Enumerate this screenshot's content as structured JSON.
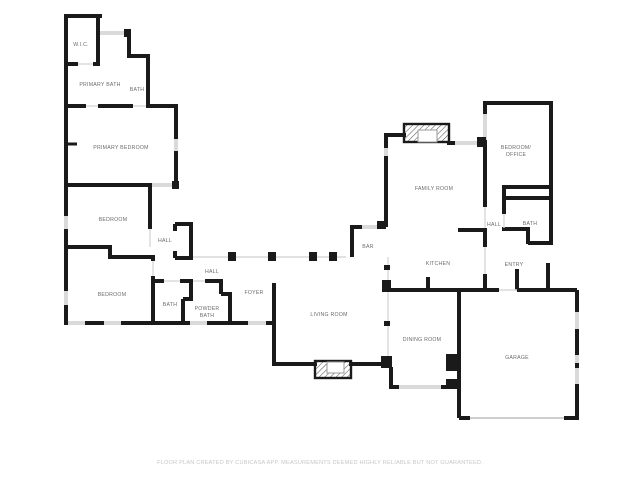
{
  "floor_plan": {
    "colors": {
      "wall": "#1a1a1a",
      "window": "#dadada",
      "opening": "#d9d9d9",
      "label": "#6b6b6b",
      "footer": "#c7c7c7"
    },
    "rooms": [
      {
        "label": "W.I.C."
      },
      {
        "label": "PRIMARY BATH"
      },
      {
        "label": "BATH"
      },
      {
        "label": "PRIMARY BEDROOM"
      },
      {
        "label": "BEDROOM"
      },
      {
        "label": "HALL"
      },
      {
        "label": "HALL"
      },
      {
        "label": "BEDROOM"
      },
      {
        "label": "BATH"
      },
      {
        "lines": [
          "POWDER",
          "BATH"
        ]
      },
      {
        "label": "FOYER"
      },
      {
        "label": "LIVING ROOM"
      },
      {
        "label": "BAR"
      },
      {
        "label": "FAMILY ROOM"
      },
      {
        "lines": [
          "BEDROOM/",
          "OFFICE"
        ]
      },
      {
        "label": "HALL"
      },
      {
        "label": "BATH"
      },
      {
        "label": "KITCHEN"
      },
      {
        "label": "ENTRY"
      },
      {
        "label": "DINING ROOM"
      },
      {
        "label": "GARAGE"
      }
    ],
    "footer": {
      "text": "FLOOR PLAN CREATED BY CUBICASA APP. MEASUREMENTS DEEMED HIGHLY RELIABLE BUT NOT GUARANTEED."
    }
  }
}
